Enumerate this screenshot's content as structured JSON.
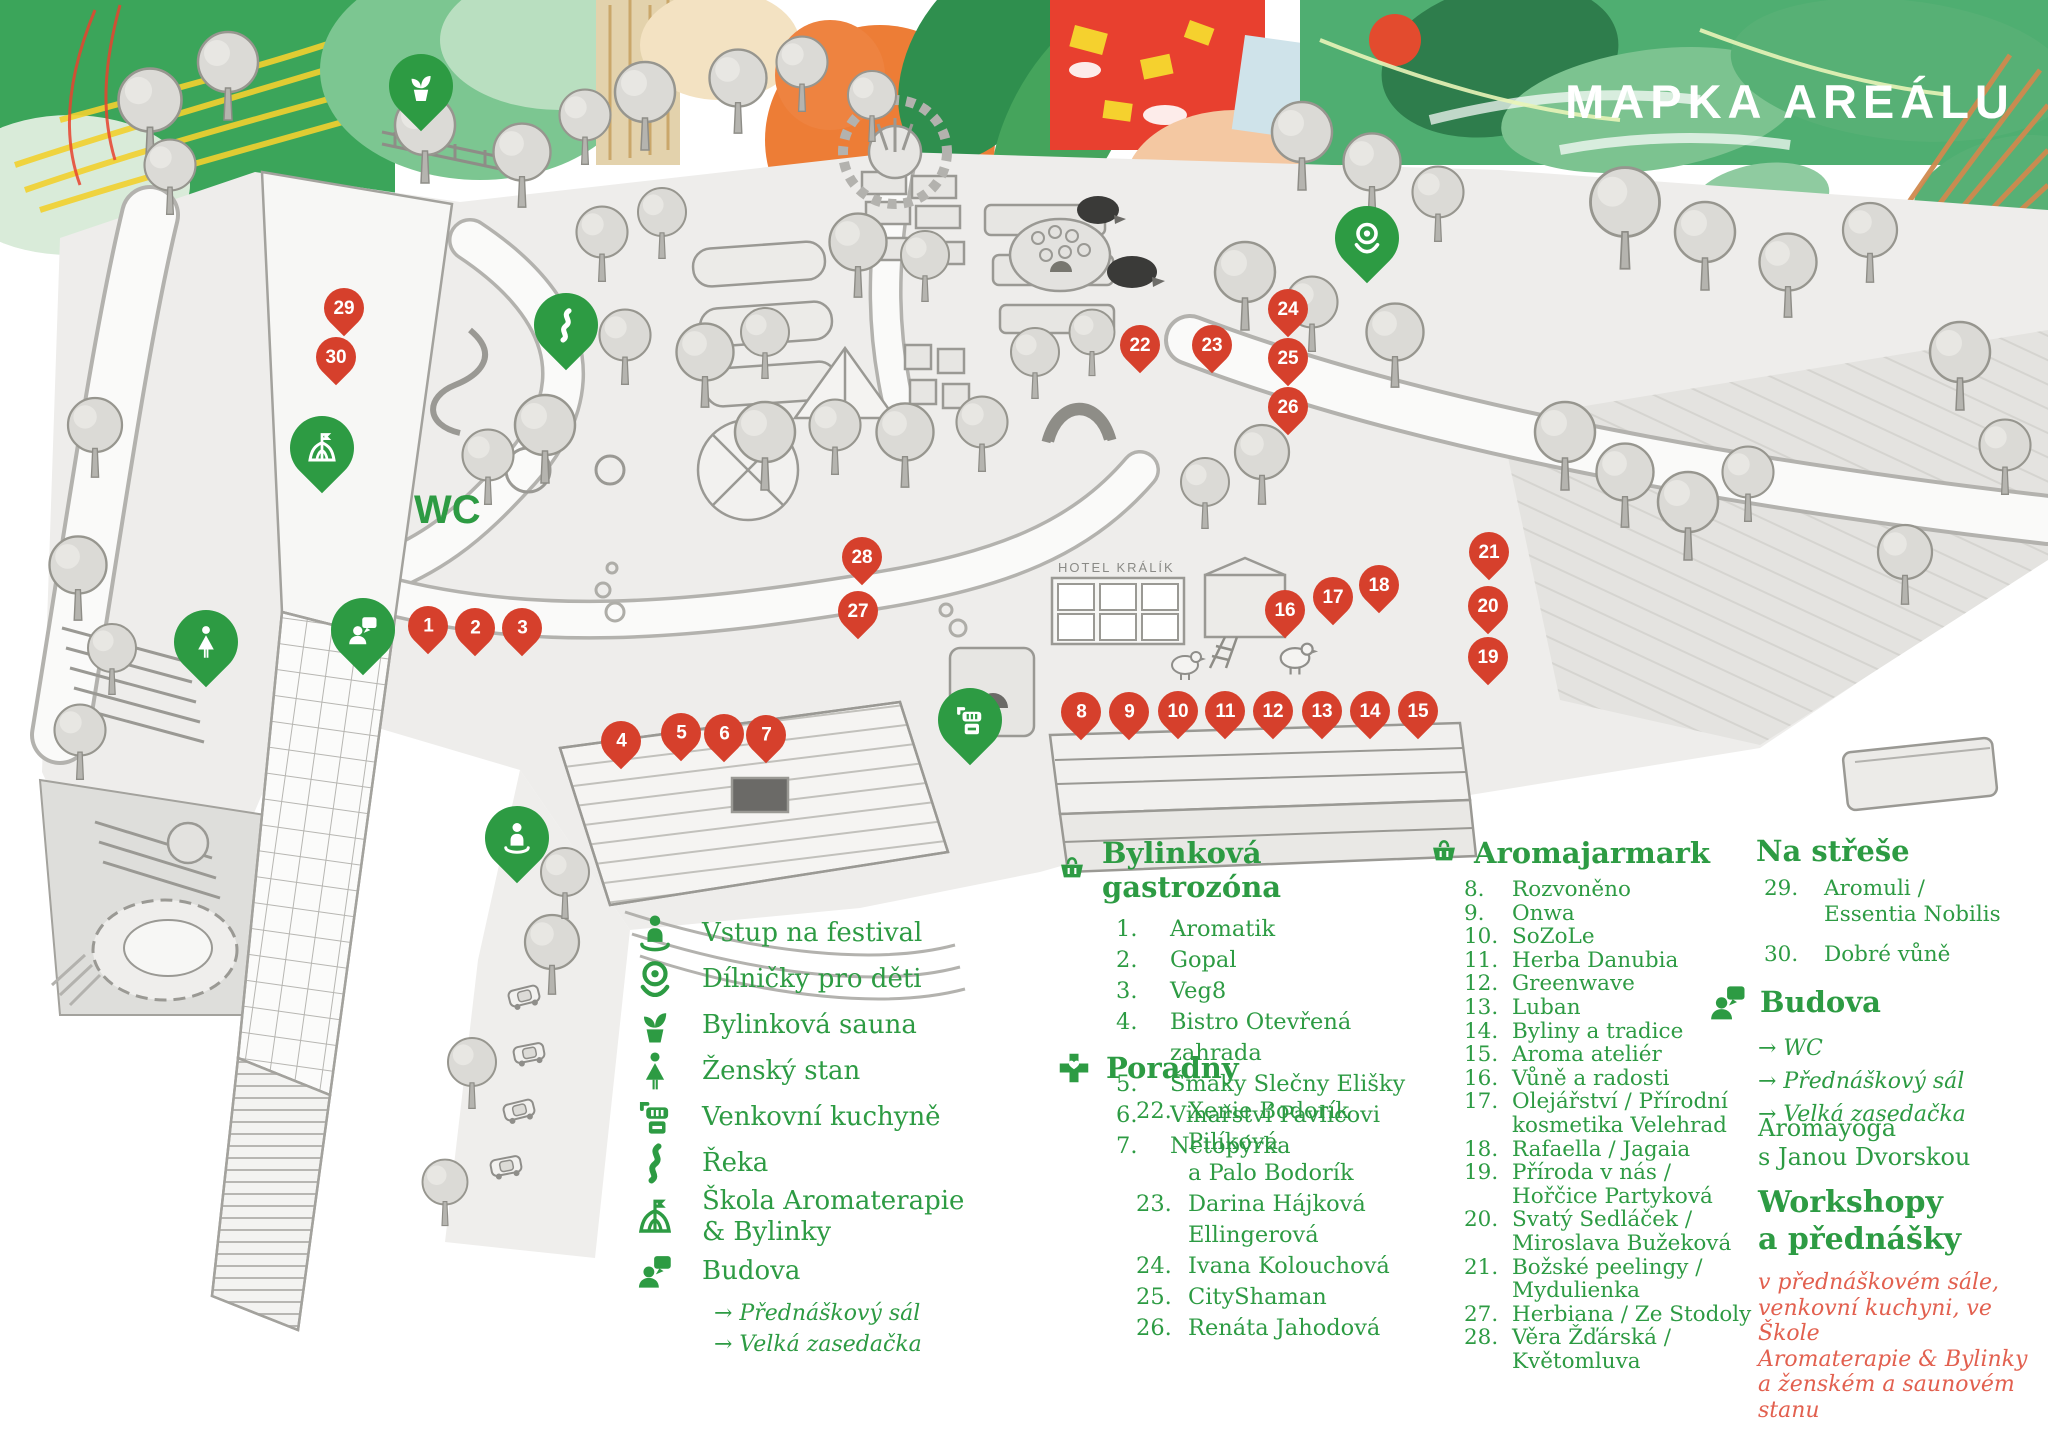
{
  "title": "MAPKA AREÁLU",
  "colors": {
    "green": "#2d9b43",
    "red_pin": "#d6402c",
    "note_red": "#e2604f"
  },
  "map_labels": {
    "wc": "WC",
    "hotel": "HOTEL KRÁLÍK"
  },
  "red_pins": [
    {
      "n": "1",
      "x": 428,
      "y": 626
    },
    {
      "n": "2",
      "x": 475,
      "y": 628
    },
    {
      "n": "3",
      "x": 522,
      "y": 628
    },
    {
      "n": "4",
      "x": 621,
      "y": 741
    },
    {
      "n": "5",
      "x": 681,
      "y": 733
    },
    {
      "n": "6",
      "x": 724,
      "y": 734
    },
    {
      "n": "7",
      "x": 766,
      "y": 735
    },
    {
      "n": "8",
      "x": 1081,
      "y": 712
    },
    {
      "n": "9",
      "x": 1129,
      "y": 712
    },
    {
      "n": "10",
      "x": 1178,
      "y": 711
    },
    {
      "n": "11",
      "x": 1225,
      "y": 711
    },
    {
      "n": "12",
      "x": 1273,
      "y": 711
    },
    {
      "n": "13",
      "x": 1322,
      "y": 711
    },
    {
      "n": "14",
      "x": 1370,
      "y": 711
    },
    {
      "n": "15",
      "x": 1418,
      "y": 711
    },
    {
      "n": "16",
      "x": 1285,
      "y": 610
    },
    {
      "n": "17",
      "x": 1333,
      "y": 597
    },
    {
      "n": "18",
      "x": 1379,
      "y": 585
    },
    {
      "n": "19",
      "x": 1488,
      "y": 657
    },
    {
      "n": "20",
      "x": 1488,
      "y": 606
    },
    {
      "n": "21",
      "x": 1489,
      "y": 552
    },
    {
      "n": "22",
      "x": 1140,
      "y": 345
    },
    {
      "n": "23",
      "x": 1212,
      "y": 345
    },
    {
      "n": "24",
      "x": 1288,
      "y": 309
    },
    {
      "n": "25",
      "x": 1288,
      "y": 358
    },
    {
      "n": "26",
      "x": 1288,
      "y": 407
    },
    {
      "n": "27",
      "x": 858,
      "y": 611
    },
    {
      "n": "28",
      "x": 862,
      "y": 557
    },
    {
      "n": "29",
      "x": 344,
      "y": 308
    },
    {
      "n": "30",
      "x": 336,
      "y": 357
    }
  ],
  "legend_left": {
    "items": [
      {
        "icon": "entrance-icon",
        "label": "Vstup na festival"
      },
      {
        "icon": "kids-icon",
        "label": "Dílničky pro děti"
      },
      {
        "icon": "plant-icon",
        "label": "Bylinková sauna"
      },
      {
        "icon": "woman-icon",
        "label": "Ženský stan"
      },
      {
        "icon": "kitchen-icon",
        "label": "Venkovní kuchyně"
      },
      {
        "icon": "river-icon",
        "label": "Řeka"
      },
      {
        "icon": "tent-icon",
        "label": "Škola Aromaterapie\n& Bylinky"
      },
      {
        "icon": "building-icon",
        "label": "Budova"
      }
    ],
    "budova_sub": [
      "→ Přednáškový sál",
      "→ Velká zasedačka"
    ]
  },
  "sections": {
    "gastro": {
      "title": "Bylinková gastrozóna",
      "items": [
        {
          "num": "1.",
          "name": "Aromatik"
        },
        {
          "num": "2.",
          "name": "Gopal"
        },
        {
          "num": "3.",
          "name": "Veg8"
        },
        {
          "num": "4.",
          "name": "Bistro Otevřená zahrada"
        },
        {
          "num": "5.",
          "name": "Šmaky Slečny Elišky"
        },
        {
          "num": "6.",
          "name": "Vinařství Pavlicovi"
        },
        {
          "num": "7.",
          "name": "Netopýrka"
        }
      ]
    },
    "poradny": {
      "title": "Poradny",
      "items": [
        {
          "num": "22.",
          "name": "Xenie Bodorík Pilíková\na Palo Bodorík"
        },
        {
          "num": "23.",
          "name": "Darina Hájková Ellingerová"
        },
        {
          "num": "24.",
          "name": "Ivana Kolouchová"
        },
        {
          "num": "25.",
          "name": "CityShaman"
        },
        {
          "num": "26.",
          "name": "Renáta Jahodová"
        }
      ]
    },
    "jarmark": {
      "title": "Aromajarmark",
      "items": [
        {
          "num": "8.",
          "name": "Rozvoněno"
        },
        {
          "num": "9.",
          "name": "Onwa"
        },
        {
          "num": "10.",
          "name": "SoZoLe"
        },
        {
          "num": "11.",
          "name": "Herba Danubia"
        },
        {
          "num": "12.",
          "name": "Greenwave"
        },
        {
          "num": "13.",
          "name": "Luban"
        },
        {
          "num": "14.",
          "name": "Byliny a tradice"
        },
        {
          "num": "15.",
          "name": "Aroma ateliér"
        },
        {
          "num": "16.",
          "name": "Vůně a radosti"
        },
        {
          "num": "17.",
          "name": "Olejářství / Přírodní\nkosmetika Velehrad"
        },
        {
          "num": "18.",
          "name": "Rafaella / Jagaia"
        },
        {
          "num": "19.",
          "name": "Příroda v nás /\nHořčice Partyková"
        },
        {
          "num": "20.",
          "name": "Svatý Sedláček /\nMiroslava Bužeková"
        },
        {
          "num": "21.",
          "name": "Božské peelingy /\nMydulienka"
        },
        {
          "num": "27.",
          "name": "Herbiana / Ze Stodoly"
        },
        {
          "num": "28.",
          "name": "Věra Žďárská /  Květomluva"
        }
      ]
    },
    "roof": {
      "title": "Na střeše",
      "items": [
        {
          "num": "29.",
          "name": "Aromuli /\nEssentia Nobilis"
        },
        {
          "num": "30.",
          "name": "Dobré vůně"
        }
      ]
    },
    "budova": {
      "title": "Budova",
      "lines": [
        "→ WC",
        "→ Přednáškový sál",
        "→ Velká zasedačka"
      ]
    },
    "aromayoga": "Aromayoga\ns Janou Dvorskou",
    "workshops": {
      "title": "Workshopy\na přednášky",
      "note": "v přednáškovém sále,\nvenkovní kuchyni, ve Škole\nAromaterapie & Bylinky\na ženském a saunovém stanu"
    }
  }
}
